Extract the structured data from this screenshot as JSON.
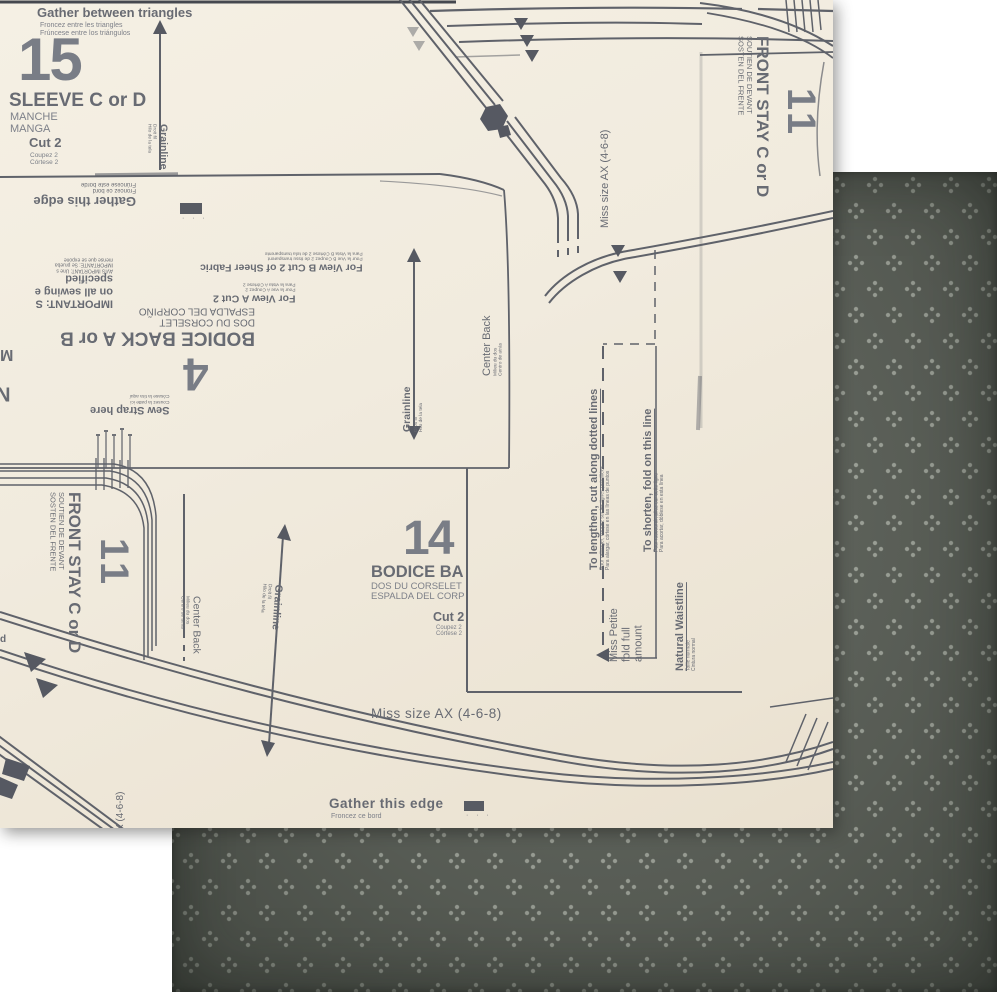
{
  "colors": {
    "cream_paper": "#f1ebde",
    "ink": "#686b73",
    "ink_dark": "#565962",
    "dark_paper": "#60655d",
    "dark_paper_dot": "#a5aaa0"
  },
  "front": {
    "gather_between": {
      "en": "Gather between triangles",
      "fr": "Froncez entre les triangles",
      "es": "Frúncese entre los triángulos"
    },
    "sleeve": {
      "num": "15",
      "title": "SLEEVE C or D",
      "fr": "MANCHE",
      "es": "MANGA"
    },
    "cut2": {
      "en": "Cut 2",
      "fr": "Coupez 2",
      "es": "Córtese 2"
    },
    "grainline": {
      "en": "Grainline",
      "fr": "Droit fil",
      "es": "Hilo de la tela"
    },
    "gather_edge": {
      "en": "Gather this edge",
      "fr": "Froncez ce bord",
      "es": "Frúncese este borde"
    },
    "bodice4": {
      "num": "4",
      "title": "BODICE BACK A or B",
      "fr": "DOS DU CORSELET",
      "es": "ESPALDA DEL CORPIÑO",
      "view_b_main": "For View B   Cut 2 of Sheer Fabric",
      "view_b_fr": "Pour la Vue B   Coupez 2 de tissu transparent",
      "view_b_es": "Para la Vista B   Córtese 2 de tela transparente",
      "view_a_main": "For View A   Cut 2",
      "view_a_fr": "Pour la vue A   Coupez 2",
      "view_a_es": "Para la vista A   Córtese 2",
      "sew_strap_en": "Sew Strap here",
      "sew_strap_fr": "Cousez la patte ici",
      "sew_strap_es": "Cósase la tira aquí",
      "important_1": "IMPORTANT: S",
      "important_2": "on all sewing e",
      "important_3": "specified",
      "important_small_1": "AVIS IMPORTANT: Une s",
      "important_small_2": "IMPORTANTE: Se prueba",
      "important_small_3": "mense que se expone"
    },
    "center_back": {
      "en": "Center Back",
      "fr": "Milieu du dos",
      "es": "Centro de atrás"
    },
    "front_stay": {
      "num": "11",
      "title": "FRONT STAY C or D",
      "fr": "SOUTIEN DE DEVANT",
      "es": "SOSTEN DEL FRENTE"
    },
    "miss_size": "Miss size AX (4-6-8)",
    "miss_size_partial": "X (4-6-8)",
    "bodice14": {
      "num": "14",
      "title": "BODICE BA",
      "fr": "DOS DU CORSELET",
      "es": "ESPALDA DEL CORP"
    },
    "lengthen": {
      "en": "To lengthen, cut along dotted lines",
      "fr": "Pour rallonger, coupez sur les lignes pointillées",
      "es": "Para alargar, córtese en las líneas de puntos"
    },
    "shorten": {
      "en": "To shorten, fold on this line",
      "fr": "Pour raccourcir, pliez sur cette ligne",
      "es": "Para acortar, dóblese en esta línea"
    },
    "petite_1": "Miss Petite",
    "petite_2": "fold full",
    "petite_3": "amount",
    "natural_waist": {
      "en": "Natural Waistline",
      "fr": "Taille normale",
      "es": "Cintura normal"
    },
    "letters": {
      "m": "M",
      "n": "N",
      "d": "d"
    },
    "label_dots": "· · ·"
  }
}
